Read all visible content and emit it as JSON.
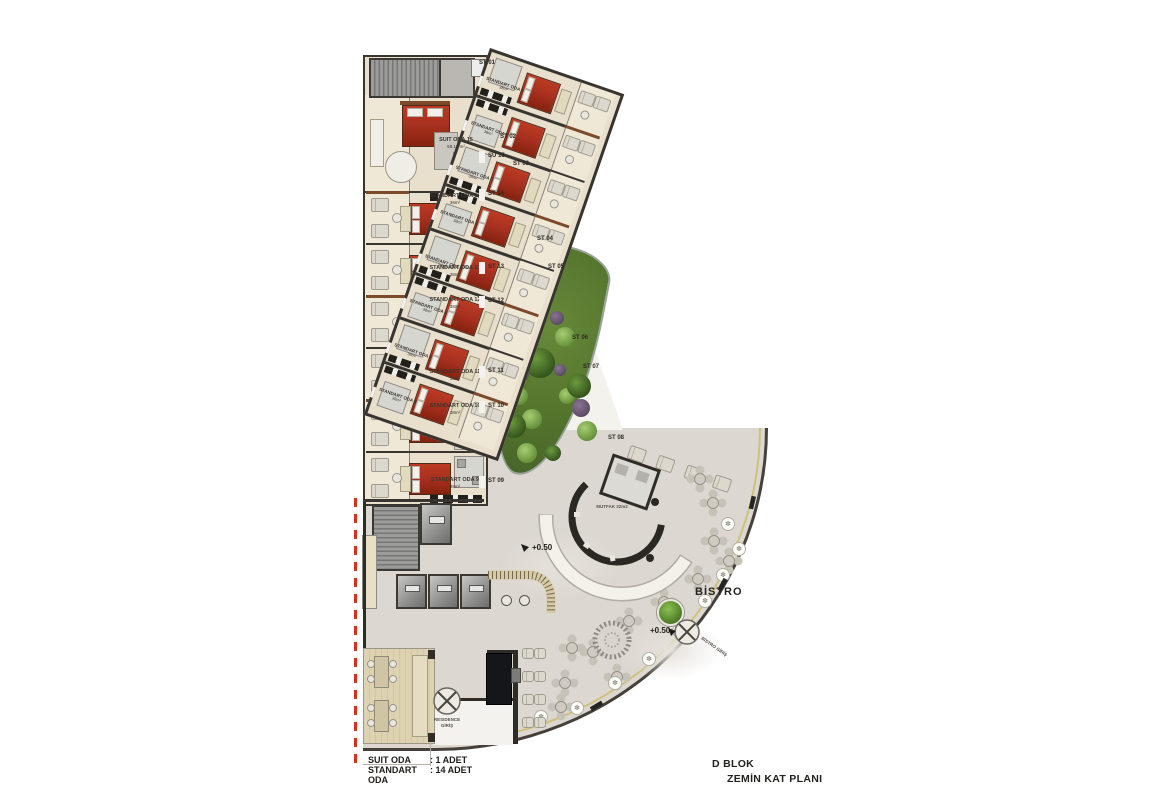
{
  "plan": {
    "title_line1": "D BLOK",
    "title_line2": "ZEMİN KAT PLANI",
    "legend": [
      {
        "name": "SUIT ODA",
        "count": ": 1 ADET"
      },
      {
        "name": "STANDART ODA",
        "count": ": 14 ADET"
      }
    ],
    "labels": {
      "bistro": "BİSTRO",
      "kitchen": "MUTFAK 32m2",
      "level_lobby": "+0.50",
      "level_bistro": "+0.50",
      "residence_entrance_line1": "RESIDENCE",
      "residence_entrance_line2": "GİRİŞ",
      "bistro_entrance": "BİSTRO GİRİŞ"
    },
    "left_wing": {
      "suite": {
        "name": "SUIT ODA 15",
        "area": "58.17 m²",
        "door": "SU 15"
      },
      "rooms": [
        {
          "name": "STANDART ODA 14",
          "area": "38m²",
          "door": "ST 14"
        },
        {
          "name": "STANDART ODA 13",
          "area": "38m²",
          "door": "ST 13"
        },
        {
          "name": "STANDART ODA 12",
          "area": "38m²",
          "door": "ST 12"
        },
        {
          "name": "STANDART ODA 11",
          "area": "38m²",
          "door": "ST 11"
        },
        {
          "name": "STANDART ODA 10",
          "area": "38m²",
          "door": "ST 10"
        },
        {
          "name": "STANDART ODA 9",
          "area": "38m²",
          "door": "ST 09"
        }
      ]
    },
    "right_wing": {
      "rooms": [
        {
          "name": "STANDART ODA 1",
          "area": "38m²",
          "door": "ST 01"
        },
        {
          "name": "STANDART ODA 2",
          "area": "38m²",
          "door": "ST 02"
        },
        {
          "name": "STANDART ODA 3",
          "area": "38m²",
          "door": "ST 03"
        },
        {
          "name": "STANDART ODA 4",
          "area": "38m²",
          "door": "ST 04"
        },
        {
          "name": "STANDART ODA 5",
          "area": "38m²",
          "door": "ST 05"
        },
        {
          "name": "STANDART ODA 6",
          "area": "38m²",
          "door": "ST 06"
        },
        {
          "name": "STANDART ODA 7",
          "area": "38m²",
          "door": "ST 07"
        },
        {
          "name": "STANDART ODA 8",
          "area": "38m²",
          "door": "ST 08"
        }
      ]
    }
  },
  "colors": {
    "bed_red": "#a93120",
    "garden_green": "#54752c",
    "section_line_red": "#d3301f",
    "wall_dark": "#383430",
    "room_floor": "#e8dfcc",
    "terrace_floor": "#efe8d7",
    "lobby_floor": "#dcd8d1",
    "accent_trim": "#cdc27c",
    "wood_brown": "#7c4a2a"
  }
}
